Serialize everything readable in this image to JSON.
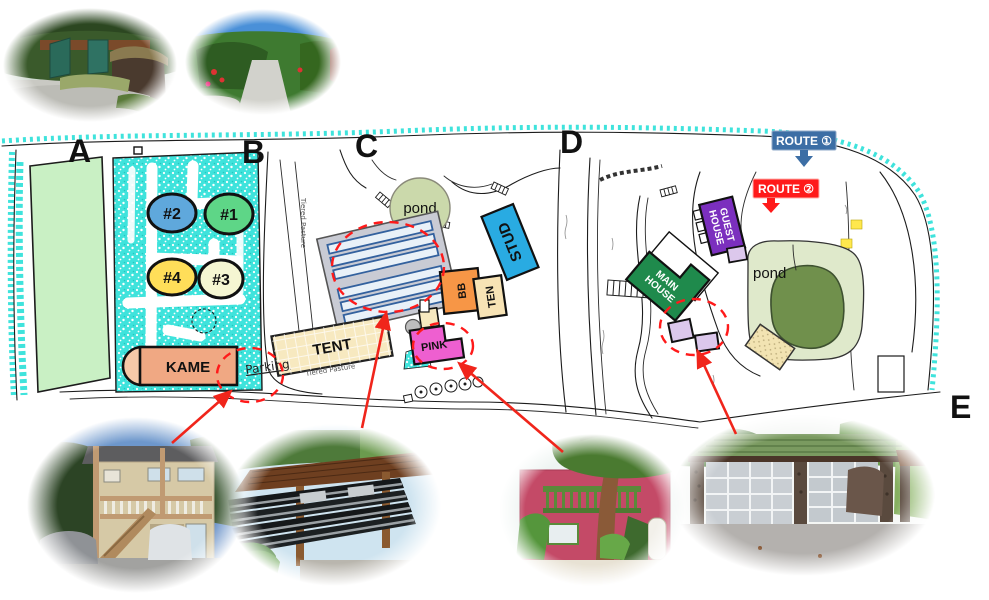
{
  "sections": {
    "a": "A",
    "b": "B",
    "c": "C",
    "d": "D",
    "e": "E"
  },
  "units": {
    "u1": {
      "label": "#1"
    },
    "u2": {
      "label": "#2"
    },
    "u3": {
      "label": "#3"
    },
    "u4": {
      "label": "#4"
    }
  },
  "buildings": {
    "kame": {
      "label": "KAME"
    },
    "tent": {
      "label": "TENT"
    },
    "pink": {
      "label": "PINK"
    },
    "bb": {
      "label": "BB"
    },
    "ten": {
      "label": "TEN"
    },
    "stud": {
      "label": "STUD"
    },
    "main_house": {
      "label": "MAIN HOUSE",
      "line1": "MAIN",
      "line2": "HOUSE"
    },
    "guest_house": {
      "label": "GUEST HOUSE",
      "line1": "GUEST",
      "line2": "HOUSE"
    }
  },
  "map_labels": {
    "pond_c": "pond",
    "pond_d": "pond",
    "parking": "Parking",
    "tiered_pasture": "Tiered Pasture"
  },
  "routes": {
    "r1": {
      "label": "ROUTE ①"
    },
    "r2": {
      "label": "ROUTE ②"
    }
  },
  "photos": {
    "top_left": {
      "name": "entrance-gate-photo"
    },
    "top_right": {
      "name": "driveway-road-photo"
    },
    "kame": {
      "name": "kame-house-photo"
    },
    "raceways": {
      "name": "raceway-tanks-photo"
    },
    "pink": {
      "name": "pink-house-photo"
    },
    "garage": {
      "name": "main-house-garage-photo"
    }
  },
  "palette": {
    "coast_cyan": "#3FE3DC",
    "field_green": "#C9F0C4",
    "unit1": "#5ED687",
    "unit2": "#5FA8DC",
    "unit3": "#F5F6D2",
    "unit4": "#FFDE59",
    "kame": "#F0A883",
    "kame_cap": "#F6C9A8",
    "tent": "#F7E9C0",
    "pink": "#EE5FD0",
    "bb": "#F79646",
    "ten": "#F7E3B5",
    "stud": "#29ABE2",
    "main_house": "#1F8A4C",
    "guest_house": "#7B2FBE",
    "cottage_lavender": "#DCC8EC",
    "pond_c": "#CBD9AB",
    "pond_d_outer": "#DFE9CB",
    "pond_d_inner": "#70904C",
    "greenhouse_gray": "#C9CBD4",
    "greenhouse_stripe": "#E9F1F8",
    "route1_blue": "#3C6EA5",
    "route2_red": "#FF1A1A",
    "annotation_red": "#FF1A1A"
  }
}
